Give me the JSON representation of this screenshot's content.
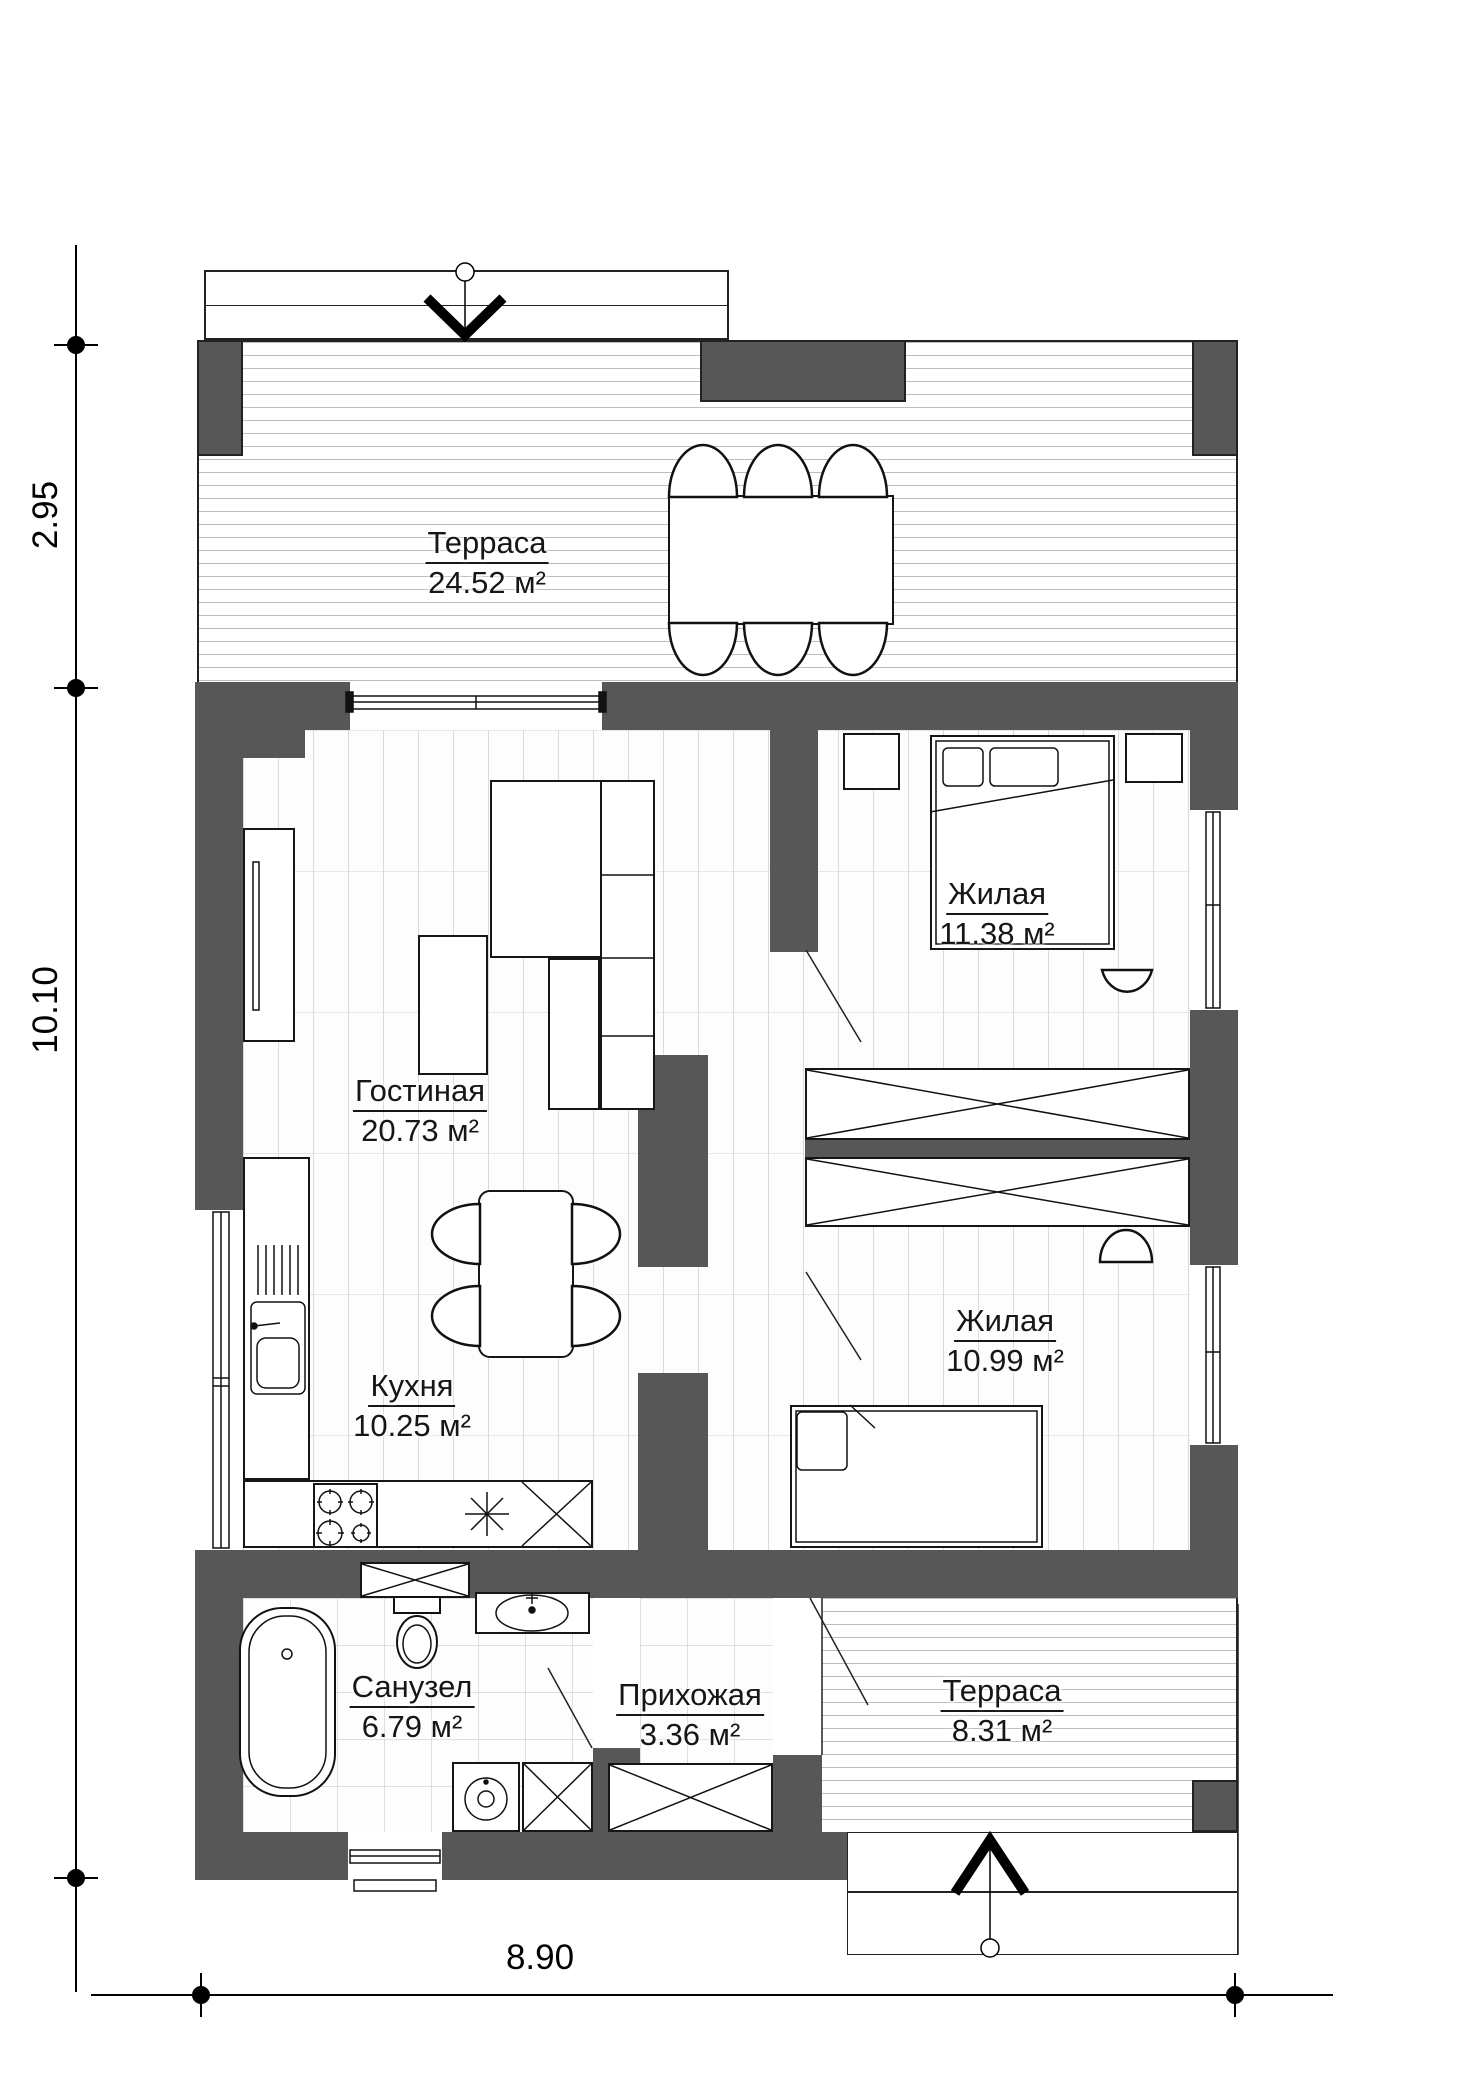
{
  "plan": {
    "title": "floor-plan",
    "rooms": [
      {
        "id": "terrace-top",
        "name": "Терраса",
        "area": "24.52 м²"
      },
      {
        "id": "living",
        "name": "Гостиная",
        "area": "20.73 м²"
      },
      {
        "id": "bedroom-1",
        "name": "Жилая",
        "area": "11.38 м²"
      },
      {
        "id": "bedroom-2",
        "name": "Жилая",
        "area": "10.99 м²"
      },
      {
        "id": "kitchen",
        "name": "Кухня",
        "area": "10.25 м²"
      },
      {
        "id": "bathroom",
        "name": "Санузел",
        "area": "6.79 м²"
      },
      {
        "id": "hallway",
        "name": "Прихожая",
        "area": "3.36 м²"
      },
      {
        "id": "terrace-bottom",
        "name": "Терраса",
        "area": "8.31 м²"
      }
    ],
    "dimensions": {
      "terrace_depth": "2.95",
      "house_depth": "10.10",
      "house_width": "8.90"
    },
    "colors": {
      "wall": "#575757",
      "line": "#111111",
      "deck_line": "#bdbdbd",
      "plank_line": "#dadada"
    }
  }
}
